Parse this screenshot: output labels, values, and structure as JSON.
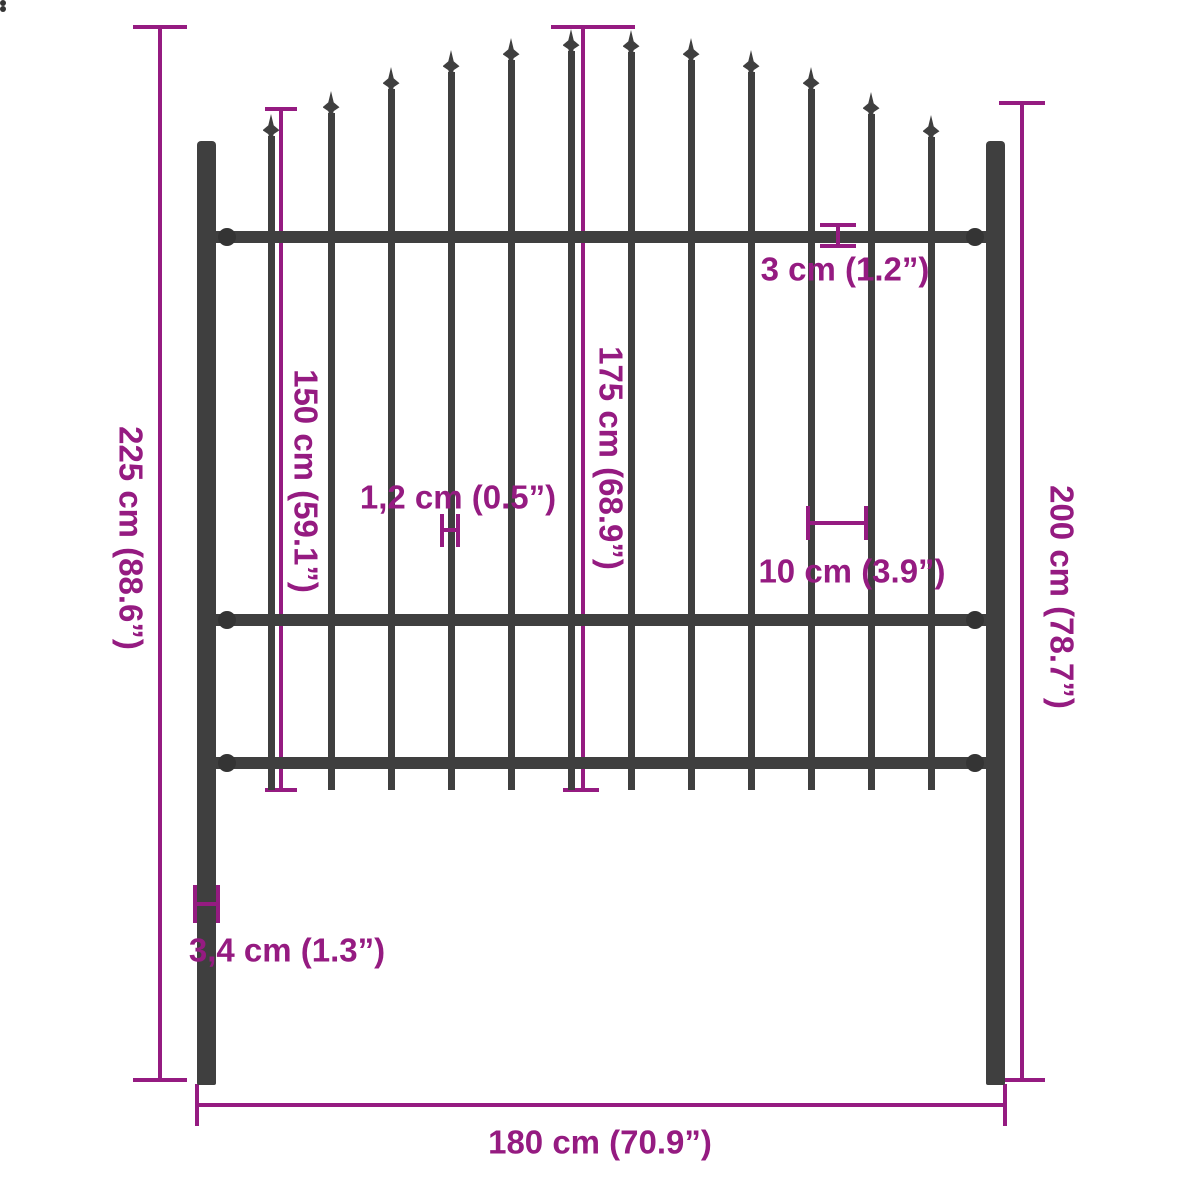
{
  "title": "Fence panel dimension diagram",
  "colors": {
    "accent": "#951b81",
    "steel": "#3f3f3f",
    "steel_dark": "#343434",
    "background": "#ffffff"
  },
  "labels": {
    "overall_height": "225 cm (88.6”)",
    "picket_height": "150 cm (59.1”)",
    "arch_center_height": "175 cm (68.9”)",
    "post_height": "200 cm (78.7”)",
    "rail_thickness": "3 cm (1.2”)",
    "picket_width": "1,2 cm (0.5”)",
    "picket_spacing": "10 cm (3.9”)",
    "post_width": "3,4 cm (1.3”)",
    "overall_width": "180 cm (70.9”)"
  },
  "fence": {
    "posts": [
      {
        "x": 197,
        "y": 141,
        "w": 19,
        "h": 944
      },
      {
        "x": 986,
        "y": 141,
        "w": 19,
        "h": 944
      }
    ],
    "rails": [
      {
        "x": 215,
        "y": 231,
        "w": 772,
        "h": 12
      },
      {
        "x": 215,
        "y": 614,
        "w": 772,
        "h": 12
      },
      {
        "x": 215,
        "y": 757,
        "w": 772,
        "h": 12
      }
    ],
    "rail_connectors": {
      "xs": [
        227,
        975
      ],
      "ys": [
        237,
        620,
        763
      ],
      "d": 18
    },
    "rivets": [
      {
        "x": 206,
        "y": 375
      },
      {
        "x": 995,
        "y": 377
      }
    ],
    "pickets": {
      "centers": [
        271,
        331,
        391,
        451,
        511,
        571,
        631,
        691,
        751,
        811,
        871,
        931
      ],
      "tips": [
        114,
        91,
        67,
        50,
        38,
        29,
        30,
        38,
        50,
        67,
        92,
        115
      ],
      "width": 7,
      "bottom": 790,
      "star_w": 17,
      "star_h": 30
    }
  }
}
